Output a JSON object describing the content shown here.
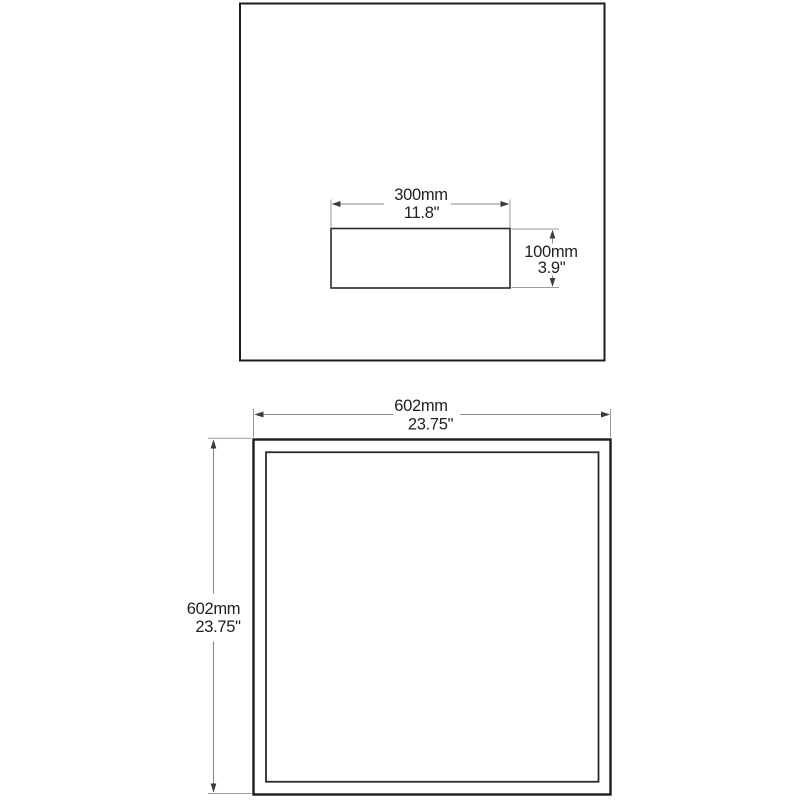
{
  "colors": {
    "background": "#ffffff",
    "outline": "#1c1c1c",
    "dimension": "#8a8a8a",
    "arrow": "#3c3c3c",
    "text": "#1f1f1f"
  },
  "views": {
    "top": {
      "width": {
        "mm": "300mm",
        "inch": "11.8\""
      },
      "height": {
        "mm": "100mm",
        "inch": "3.9\""
      }
    },
    "front": {
      "width": {
        "mm": "602mm",
        "inch": "23.75\""
      },
      "height": {
        "mm": "602mm",
        "inch": "23.75\""
      }
    }
  }
}
